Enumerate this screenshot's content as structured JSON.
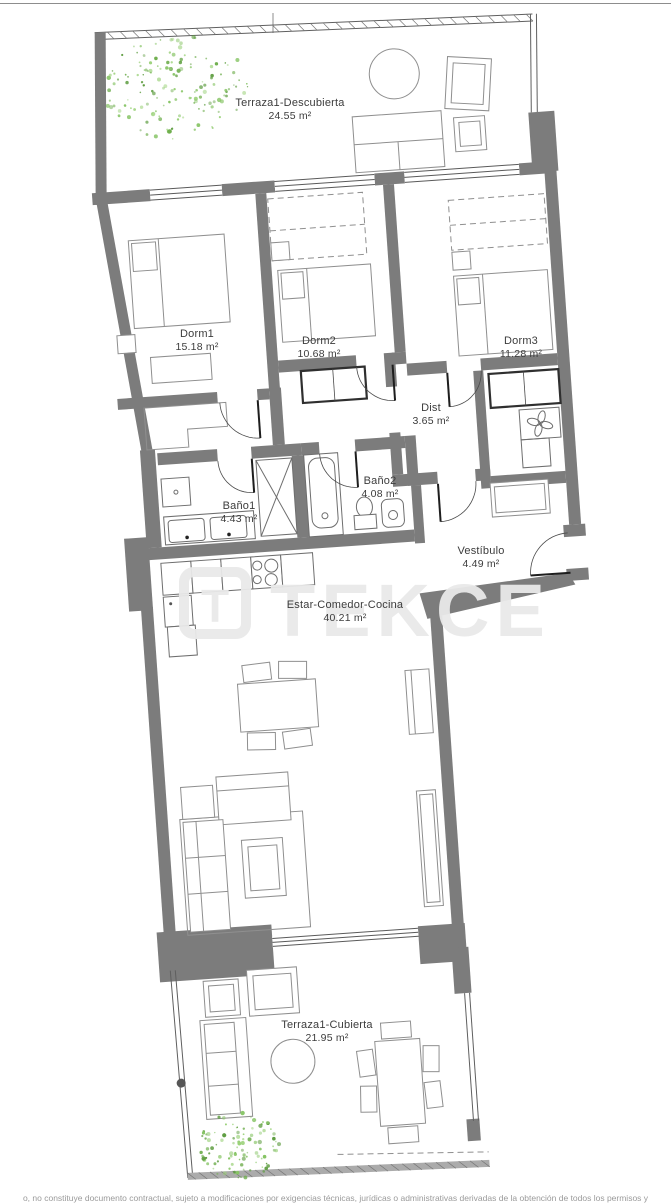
{
  "watermark": {
    "text": "TEKCE",
    "logo_letter": "T"
  },
  "rooms": [
    {
      "id": "terraza1-descubierta",
      "name": "Terraza1-Descubierta",
      "area": "24.55 m²"
    },
    {
      "id": "dorm1",
      "name": "Dorm1",
      "area": "15.18 m²"
    },
    {
      "id": "dorm2",
      "name": "Dorm2",
      "area": "10.68 m²"
    },
    {
      "id": "dorm3",
      "name": "Dorm3",
      "area": "11.28 m²"
    },
    {
      "id": "dist",
      "name": "Dist",
      "area": "3.65 m²"
    },
    {
      "id": "bano1",
      "name": "Baño1",
      "area": "4.43 m²"
    },
    {
      "id": "bano2",
      "name": "Baño2",
      "area": "4.08 m²"
    },
    {
      "id": "vestibulo",
      "name": "Vestíbulo",
      "area": "4.49 m²"
    },
    {
      "id": "estar-comedor-cocina",
      "name": "Estar-Comedor-Cocina",
      "area": "40.21 m²"
    },
    {
      "id": "terraza1-cubierta",
      "name": "Terraza1-Cubierta",
      "area": "21.95 m²"
    }
  ],
  "footer": {
    "disclaimer": "o, no constituye documento contractual, sujeto a modificaciones por exigencias técnicas, jurídicas o administrativas derivadas de la obtención de todos los permisos y"
  },
  "colors": {
    "wall": "#7c7c7c",
    "label_text": "#3c3c3c",
    "green": "#6fae4e",
    "watermark": "#e9e9e9"
  }
}
